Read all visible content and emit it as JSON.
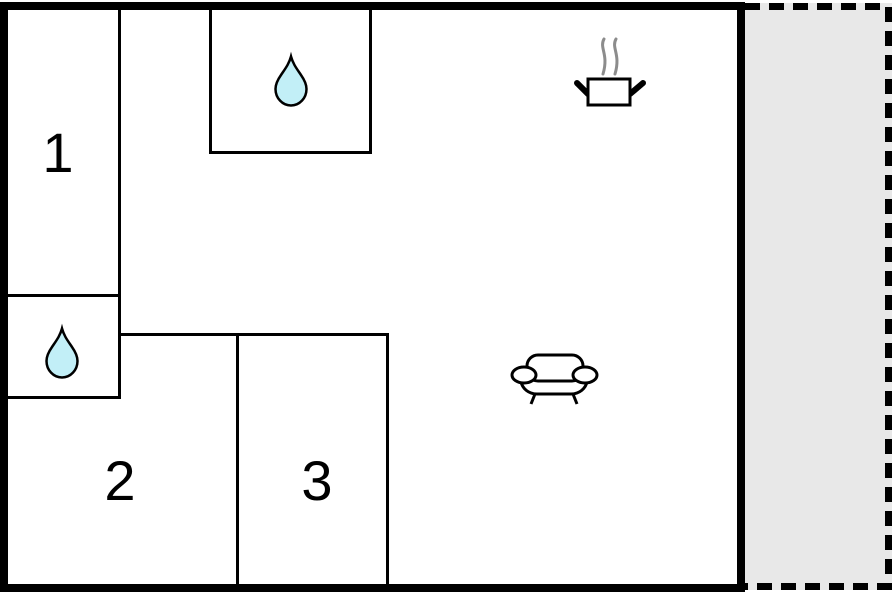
{
  "plan": {
    "title": "floor-plan",
    "rooms": [
      {
        "label": "1"
      },
      {
        "label": "2"
      },
      {
        "label": "3"
      }
    ],
    "icons": {
      "bathroom_top": "water-drop-icon",
      "bathroom_left": "water-drop-icon",
      "kitchen": "cooking-pot-icon",
      "living_room": "sofa-icon"
    },
    "colors": {
      "wall": "#000000",
      "background": "#ffffff",
      "water_drop_fill": "#c2eff7",
      "terrace_fill": "#e8e8e8",
      "steam": "#8c8c8c"
    }
  }
}
